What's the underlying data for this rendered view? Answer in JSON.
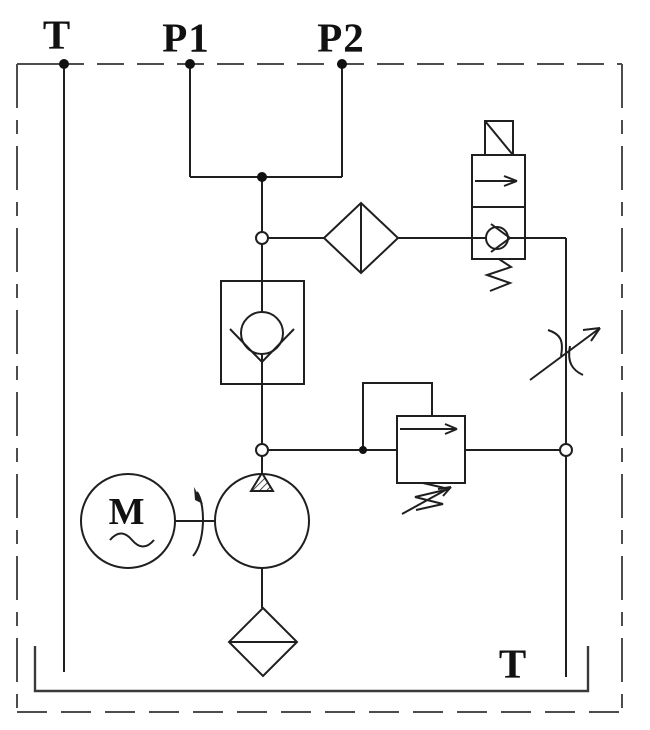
{
  "diagram": {
    "title": "Hydraulic power unit schematic",
    "labels": {
      "port_t_top": "T",
      "port_p1": "P1",
      "port_p2": "P2",
      "tank_return_t": "T",
      "motor": "M"
    },
    "components": [
      "electric-motor",
      "pump",
      "check-valve",
      "pressure-filter",
      "solenoid-operated-check-valve",
      "adjustable-flow-control-valve",
      "adjustable-relief-valve",
      "suction-strainer",
      "reservoir",
      "enclosure-boundary"
    ],
    "colors": {
      "line": "#1f1f1f",
      "boundary": "#4d4d4d",
      "background": "#ffffff"
    }
  }
}
